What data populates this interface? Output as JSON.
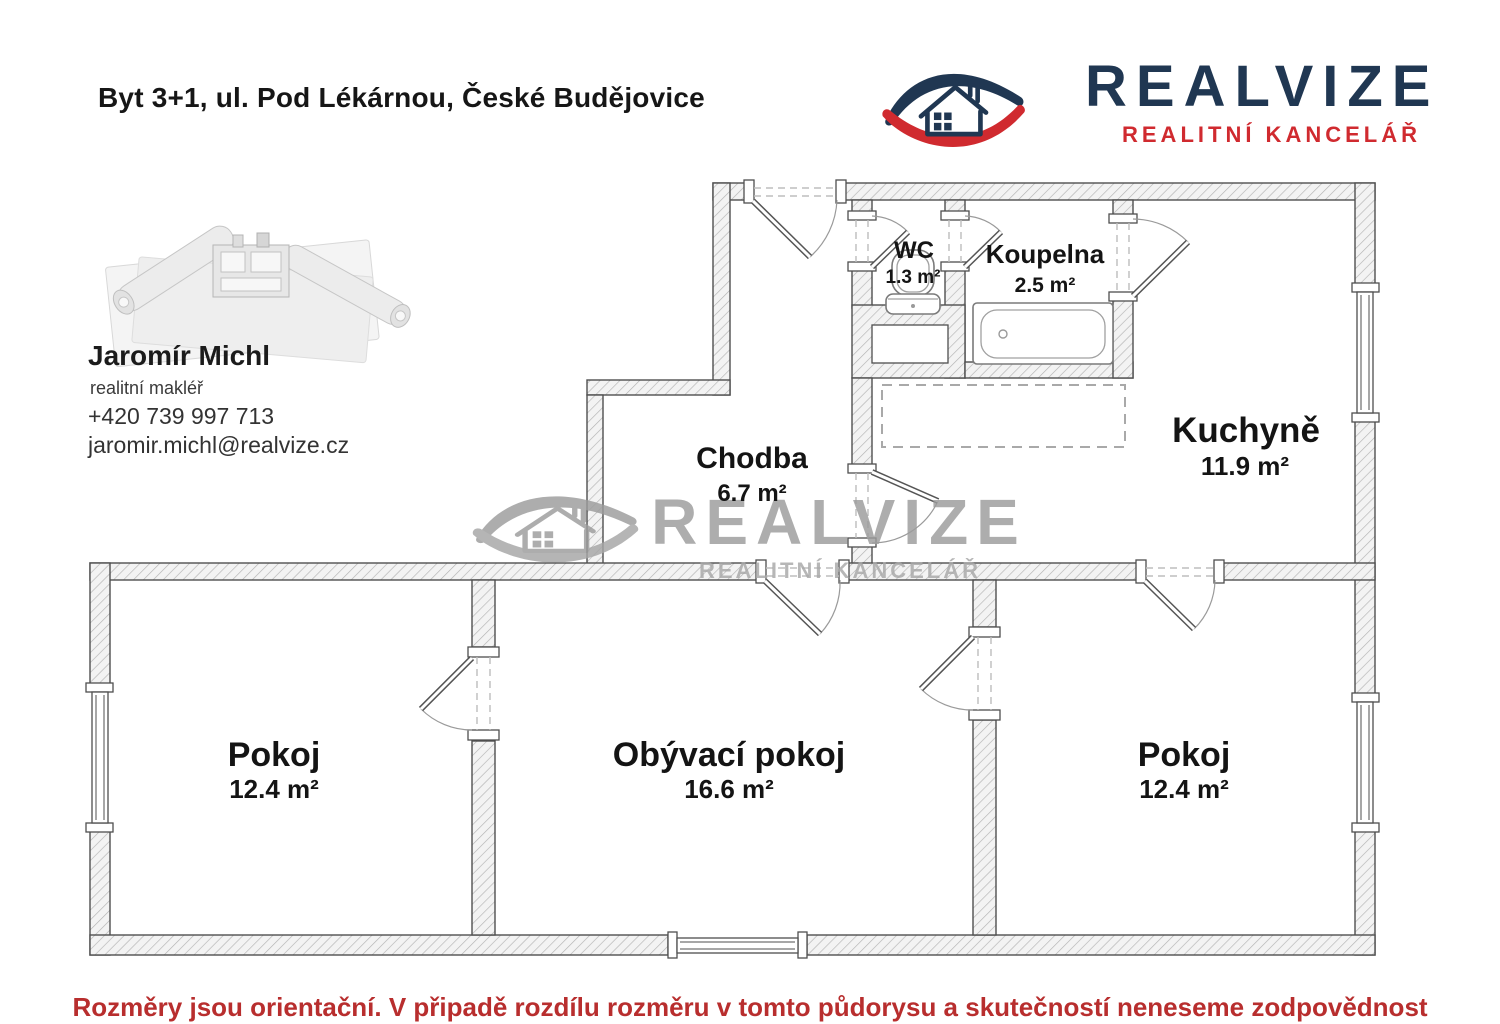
{
  "header": {
    "title": "Byt 3+1, ul. Pod Lékárnou, České Budějovice",
    "logo": {
      "brand": "REALVIZE",
      "subtitle": "REALITNÍ KANCELÁŘ",
      "navy": "#203752",
      "red": "#d02a2f"
    }
  },
  "agent": {
    "name": "Jaromír Michl",
    "role": "realitní makléř",
    "phone": "+420 739 997 713",
    "email": "jaromir.michl@realvize.cz"
  },
  "watermark": {
    "brand": "REALVIZE",
    "subtitle": "REALITNÍ KANCELÁŘ",
    "color": "#9c9c9c"
  },
  "floorplan": {
    "rooms": {
      "wc": {
        "name": "WC",
        "area": "1.3 m²"
      },
      "koupelna": {
        "name": "Koupelna",
        "area": "2.5 m²"
      },
      "kuchyne": {
        "name": "Kuchyně",
        "area": "11.9 m²"
      },
      "chodba": {
        "name": "Chodba",
        "area": "6.7 m²"
      },
      "pokoj_left": {
        "name": "Pokoj",
        "area": "12.4 m²"
      },
      "obyvaci": {
        "name": "Obývací pokoj",
        "area": "16.6 m²"
      },
      "pokoj_right": {
        "name": "Pokoj",
        "area": "12.4 m²"
      }
    }
  },
  "footer": {
    "disclaimer": "Rozměry jsou orientační. V připadě rozdílu rozměru v tomto půdorysu a skutečností neneseme zodpovědnost",
    "color": "#b82e2e"
  }
}
